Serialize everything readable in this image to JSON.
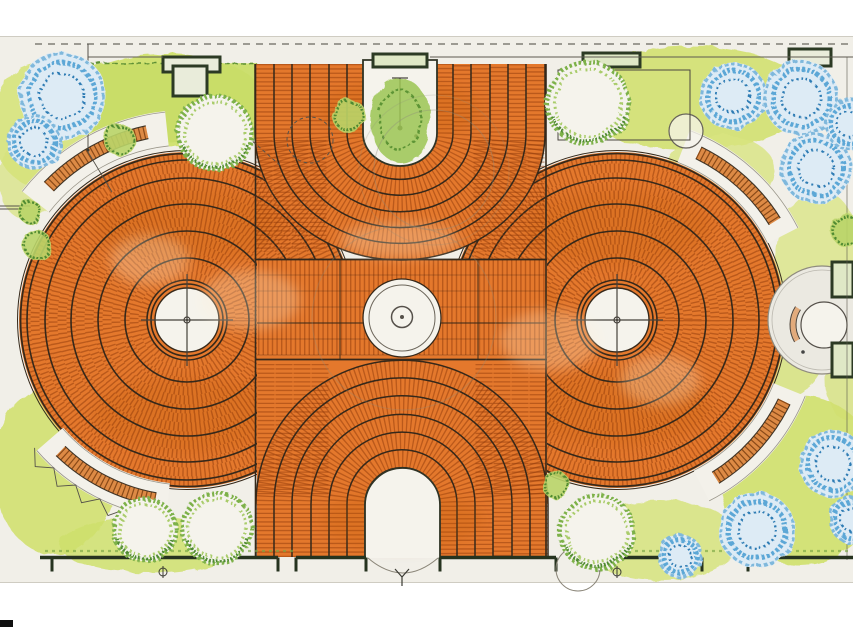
{
  "palette": {
    "paper": "#f1efe8",
    "paperWhite": "#f5f3ec",
    "paperEdge": "#cfccc2",
    "orange": "#e4782c",
    "joint": "rgba(143,58,10,0.5)",
    "sep": "#35281a",
    "line": "#44403a",
    "wall": "#26331f",
    "planterStroke": "#2c3a24",
    "planterFill": "#e9ecda",
    "planterFill2": "#dfe8c6",
    "groundA": "#cfe06c",
    "groundB": "#d6e37c",
    "groundC": "#d2e070",
    "groundD": "#d8e480",
    "hedge": "#c9dd68",
    "hedgeEdge": "#5d8f35",
    "treeFringe": "#7db14a",
    "treeFringe2": "#a9cc6b",
    "treeDark": "#4f8a31",
    "shrubFill": "#b9d468",
    "blueLight": "#ddebf5",
    "blue": "#5ba7d6",
    "blueDark": "#2e7cb4",
    "blueMid": "#7fb8dc",
    "benchFill": "#dd8a45",
    "benchTick": "#8a4a18",
    "benchEdge": "#3f3426",
    "walk": "#f3f1ea",
    "walkEdge": "#9a968a",
    "pencil": "#8f8c7c",
    "grass": "#7aa744",
    "shade": "rgba(190,85,20,0.20)",
    "cream": "rgba(255,240,215,0.28)",
    "channelGreen": "#9cc653",
    "channelGreenDark": "#5d9435",
    "black": "#101010"
  },
  "canvas": {
    "width": 853,
    "height": 627,
    "paper": [
      0,
      36,
      853,
      547
    ]
  },
  "plaza": {
    "discs": [
      {
        "cx": 187,
        "cy": 320
      },
      {
        "cx": 617,
        "cy": 320
      }
    ],
    "discOuterR": 168,
    "jointRings": {
      "start": 44,
      "step": 9,
      "count": 14,
      "width": 9,
      "dash": "1.4 3"
    },
    "separatorRadii": [
      36,
      40,
      62,
      89,
      116,
      142,
      160
    ],
    "outerDouble": [
      166.5,
      169.5
    ],
    "hub": {
      "whiteR": 32,
      "crossLen": 46,
      "innerR": 3
    },
    "band": {
      "x": 257,
      "y": 259,
      "w": 290,
      "h": 101,
      "rowStep": 16,
      "strongYs": [
        259.5,
        359.5
      ],
      "midY": 323,
      "verticalXs": [
        340,
        478
      ]
    },
    "fanTop": {
      "cx": 400,
      "topY": 64,
      "cyl": 133,
      "radii": [
        35,
        53,
        71,
        90,
        108,
        126,
        145
      ],
      "ryFactor": 0.876,
      "left": 255,
      "right": 545,
      "cornerCols": [
        264,
        282,
        300,
        318
      ],
      "cornerColYs": [
        140,
        252
      ]
    },
    "fanBottom": {
      "cx": 402,
      "botY": 557,
      "cyl": 504,
      "radii": [
        37,
        55,
        73,
        91,
        110,
        128,
        146
      ],
      "ryFactor": 0.985,
      "left": 256,
      "right": 548,
      "crestY": 360,
      "cornerCols": [
        266,
        284,
        302,
        320
      ],
      "cornerColYs": [
        364,
        496
      ]
    },
    "edgeLines": [
      255.5,
      546
    ],
    "channel": {
      "x1": 363,
      "x2": 437,
      "top": 60,
      "cy": 133,
      "r": 37,
      "ry": 33
    },
    "door": {
      "x1": 365,
      "x2": 440,
      "bottom": 558,
      "cy": 505,
      "r": 37.5,
      "ry": 37
    },
    "fountain": {
      "cx": 402,
      "cy": 318,
      "outerR": 39,
      "ringR": 33,
      "innerR": 10.5
    },
    "shade": [
      [
        187,
        225,
        95,
        38
      ],
      [
        187,
        415,
        95,
        38
      ],
      [
        617,
        228,
        95,
        38
      ],
      [
        617,
        408,
        95,
        38
      ],
      [
        400,
        300,
        120,
        26
      ],
      [
        335,
        470,
        55,
        35
      ],
      [
        468,
        472,
        55,
        35
      ],
      [
        400,
        175,
        75,
        35
      ],
      [
        300,
        320,
        40,
        50
      ],
      [
        520,
        320,
        40,
        50
      ]
    ],
    "shadeFan": [
      [
        400,
        110,
        80,
        30
      ],
      [
        402,
        520,
        80,
        30
      ]
    ],
    "cream": [
      [
        250,
        300,
        50,
        30
      ],
      [
        550,
        340,
        50,
        30
      ],
      [
        400,
        240,
        60,
        18
      ],
      [
        150,
        260,
        40,
        25
      ],
      [
        660,
        380,
        40,
        25
      ]
    ]
  },
  "ground": {
    "blobs": [
      [
        165,
        100,
        100,
        46,
        "groundA",
        0.95
      ],
      [
        40,
        125,
        48,
        62,
        "groundB",
        0.9
      ],
      [
        690,
        98,
        120,
        52,
        "groundC",
        0.9
      ],
      [
        820,
        270,
        45,
        80,
        "groundD",
        0.75
      ],
      [
        800,
        480,
        80,
        85,
        "groundA",
        0.9
      ],
      [
        660,
        540,
        80,
        40,
        "groundB",
        0.85
      ],
      [
        55,
        470,
        62,
        85,
        "groundC",
        0.9
      ],
      [
        150,
        545,
        90,
        28,
        "groundA",
        0.85
      ],
      [
        720,
        170,
        55,
        35,
        "groundD",
        0.8
      ],
      [
        770,
        350,
        55,
        50,
        "groundC",
        0.75
      ],
      [
        846,
        380,
        20,
        40,
        "groundC",
        0.7
      ],
      [
        28,
        180,
        30,
        40,
        "groundB",
        0.7
      ]
    ],
    "hedge": {
      "path": "M70,64 L256,62 L258,138 C200,146 120,140 70,132 Z",
      "edgeTop": [
        72,
        63,
        256,
        63
      ],
      "edgeRight": [
        256,
        63,
        257,
        138
      ]
    }
  },
  "trees": {
    "green": [
      [
        215,
        133,
        38
      ],
      [
        588,
        103,
        42
      ],
      [
        145,
        530,
        32
      ],
      [
        217,
        528,
        36
      ],
      [
        597,
        532,
        38
      ]
    ],
    "blue": [
      [
        62,
        96,
        44
      ],
      [
        34,
        142,
        27
      ],
      [
        733,
        96,
        34
      ],
      [
        801,
        98,
        38
      ],
      [
        816,
        168,
        36
      ],
      [
        850,
        124,
        26
      ],
      [
        833,
        464,
        34
      ],
      [
        757,
        530,
        38
      ],
      [
        680,
        556,
        22
      ],
      [
        853,
        520,
        24
      ]
    ],
    "shrubs": [
      [
        349,
        116,
        17
      ],
      [
        120,
        140,
        16
      ],
      [
        37,
        245,
        15
      ],
      [
        30,
        212,
        12
      ],
      [
        846,
        230,
        16
      ],
      [
        556,
        485,
        14
      ]
    ],
    "channelTree": {
      "cx": 400,
      "cy": 120,
      "rx": 30,
      "ry": 42
    },
    "stoneCircle": [
      686,
      131,
      17
    ]
  },
  "furniture": {
    "benches": [
      {
        "c": 0,
        "r": 192,
        "a1": 224,
        "a2": 258
      },
      {
        "c": 0,
        "r": 182,
        "a1": 100,
        "a2": 134
      },
      {
        "c": 1,
        "r": 186,
        "a1": 296,
        "a2": 328
      },
      {
        "c": 1,
        "r": 186,
        "a1": 26,
        "a2": 58
      }
    ],
    "walks": [
      {
        "c": 0,
        "r": 192,
        "a1": 218,
        "a2": 264
      },
      {
        "c": 0,
        "r": 182,
        "a1": 96,
        "a2": 139
      },
      {
        "c": 1,
        "r": 186,
        "a1": 291,
        "a2": 333
      },
      {
        "c": 1,
        "r": 186,
        "a1": 22,
        "a2": 63
      }
    ],
    "zigzag": {
      "c": 0,
      "a1": 100,
      "a2": 140,
      "r1": 199,
      "r2": 211,
      "step": 4
    },
    "alcove": {
      "cx": 822,
      "cy": 320,
      "r": 54,
      "innerCircle": [
        824,
        325,
        23
      ],
      "benchR": [
        28,
        34
      ],
      "benchMidR": 31,
      "benchA": [
        150,
        213
      ],
      "dot": [
        803,
        352
      ]
    },
    "planters": [
      [
        163,
        57,
        57,
        15,
        "planterFill"
      ],
      [
        173,
        66,
        34,
        30,
        "planterFill"
      ],
      [
        373,
        54,
        54,
        13,
        "planterFill2"
      ],
      [
        583,
        53,
        57,
        14,
        "planterFill2"
      ],
      [
        789,
        49,
        42,
        17,
        "planterFill"
      ],
      [
        832,
        262,
        21,
        35,
        "planterFill2"
      ],
      [
        832,
        343,
        21,
        34,
        "planterFill2"
      ]
    ],
    "plotRect": [
      558,
      70,
      132,
      70
    ]
  },
  "annotations": {
    "dashedTopLine": {
      "y": 44,
      "x1": 35,
      "x2": 853
    },
    "topWallSegments": [
      [
        88,
        163
      ],
      [
        430,
        853
      ]
    ],
    "topWallY": 57,
    "leftJogLine": [
      88,
      44,
      88,
      152
    ],
    "poleDots": [
      [
        88,
        99,
        2.5
      ],
      [
        88,
        150,
        1.5
      ]
    ],
    "poleLink": [
      88,
      152,
      112,
      192
    ],
    "channelPole": [
      400,
      78,
      400,
      128
    ],
    "channelPoleDots": [
      [
        400,
        128,
        2.5
      ],
      [
        416,
        136,
        1.8
      ]
    ],
    "leftEdgeLines": [
      [
        0,
        206,
        30,
        206
      ],
      [
        0,
        209,
        24,
        209
      ]
    ],
    "rightEdgeLine": [
      847,
      57,
      847,
      560
    ],
    "dashedCircle": [
      310,
      140,
      23
    ],
    "dashedDiag": [
      243,
      133,
      281,
      166
    ],
    "pencilCircles": [
      [
        434,
        170,
        60,
        0.38
      ],
      [
        434,
        170,
        75,
        0.22
      ],
      [
        404,
        318,
        92,
        0.3
      ]
    ]
  },
  "walls": {
    "y": 557.5,
    "segments": [
      [
        40,
        278
      ],
      [
        296,
        366
      ],
      [
        440,
        556
      ],
      [
        600,
        702
      ],
      [
        748,
        853
      ]
    ],
    "ticks": [
      52,
      278,
      296,
      366,
      440,
      556,
      600,
      702,
      748
    ],
    "tickLen": 14,
    "grassY": 551,
    "grass": [
      [
        45,
        295
      ],
      [
        600,
        850
      ]
    ],
    "swingCircle": [
      578,
      569,
      22
    ],
    "swingArc": [
      368,
      558,
      403,
      588,
      438,
      558
    ],
    "ySymbol": [
      402,
      571
    ],
    "phiSymbols": [
      [
        163,
        572
      ],
      [
        617,
        572
      ]
    ]
  },
  "cornerSquare": [
    0,
    620,
    13,
    7
  ]
}
